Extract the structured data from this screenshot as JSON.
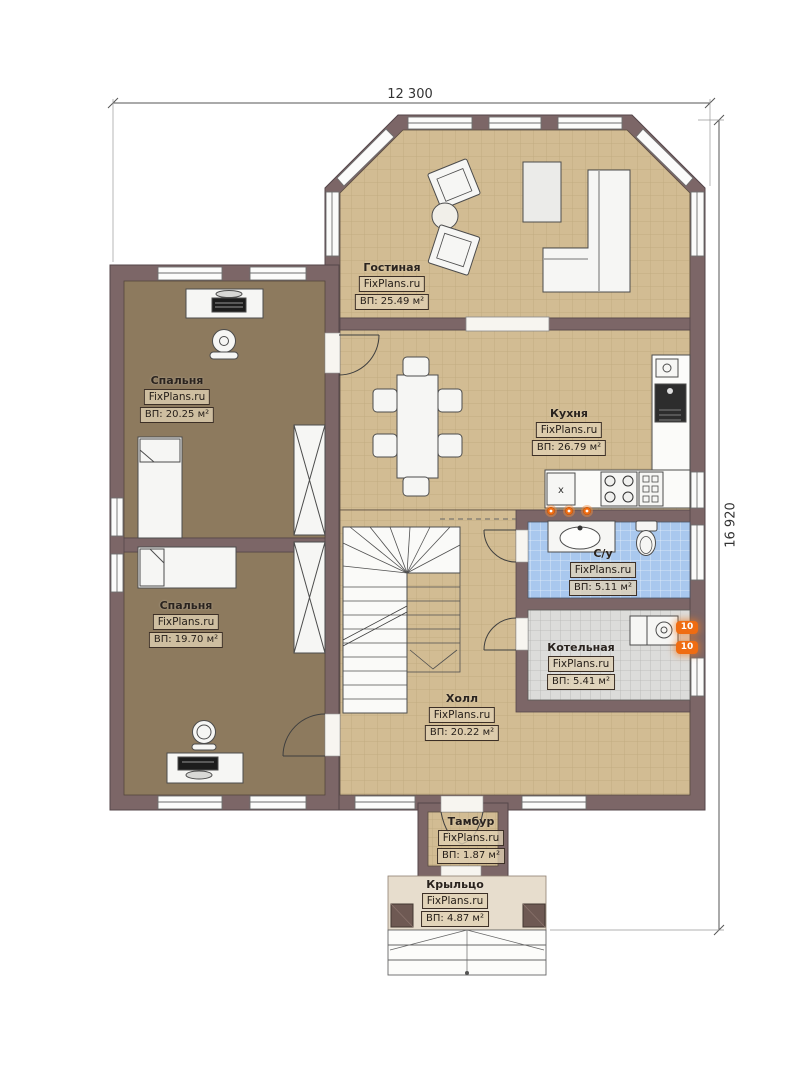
{
  "plan": {
    "watermark": "FixPlans.ru",
    "dimensions": {
      "width": "12 300",
      "height": "16 920"
    },
    "rooms": [
      {
        "key": "living-room",
        "name": "Гостиная",
        "area": "ВП: 25.49 м²"
      },
      {
        "key": "kitchen",
        "name": "Кухня",
        "area": "ВП: 26.79 м²"
      },
      {
        "key": "bedroom-1",
        "name": "Спальня",
        "area": "ВП: 20.25 м²"
      },
      {
        "key": "bedroom-2",
        "name": "Спальня",
        "area": "ВП: 19.70 м²"
      },
      {
        "key": "hall",
        "name": "Холл",
        "area": "ВП: 20.22 м²"
      },
      {
        "key": "bathroom",
        "name": "С/у",
        "area": "ВП: 5.11 м²"
      },
      {
        "key": "boiler-room",
        "name": "Котельная",
        "area": "ВП: 5.41 м²"
      },
      {
        "key": "vestibule",
        "name": "Тамбур",
        "area": "ВП: 1.87 м²"
      },
      {
        "key": "porch",
        "name": "Крыльцо",
        "area": "ВП: 4.87 м²"
      }
    ],
    "markers": {
      "appliance": "x",
      "radiator": "10"
    },
    "colors": {
      "wall": "#7c6667",
      "tile_floor": "#d2bc93",
      "wood_floor": "#8d7a5e",
      "bath_floor": "#a9c8ee",
      "boiler_floor": "#dcdcda",
      "marker_orange": "#ef6c12"
    }
  }
}
